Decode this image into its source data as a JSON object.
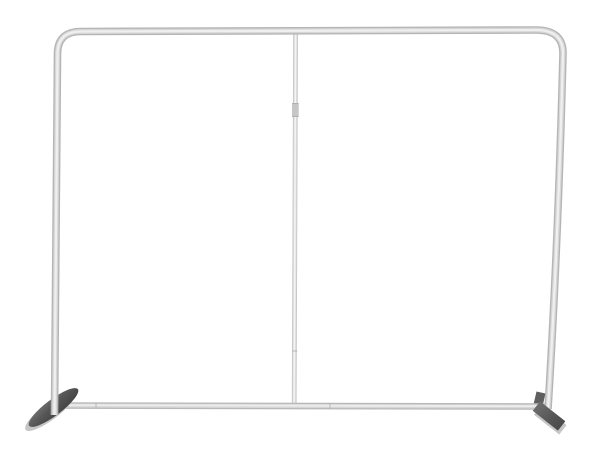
{
  "scene": {
    "type": "product-photo",
    "description": "Empty silver aluminum tube frame for a tension-fabric display backdrop, rounded top corners, vertical center support pole, two dark angled stabilizer feet, on a plain white background",
    "parts": {
      "top_bar": "top horizontal tube",
      "left_leg": "left vertical tube",
      "right_leg": "right vertical tube",
      "bottom_bar": "bottom horizontal tube",
      "center_pole": "thin center support pole with connector sleeve",
      "left_foot": "left angled stabilizer foot",
      "right_foot": "right angled stabilizer foot"
    }
  },
  "palette": {
    "background": "#ffffff",
    "tube_edge": "#b5b5b5",
    "tube_mid": "#d6d6d6",
    "tube_highlight": "#efefef",
    "bar_edge": "#b8b8b8",
    "bar_mid": "#d6d6d6",
    "bar_highlight": "#ececec",
    "pole_edge": "#c9c9c9",
    "pole_mid": "#e2e2e2",
    "pole_highlight": "#f4f4f4",
    "pole_joint": "#c6c6c6",
    "seam": "#a9a9a9",
    "bar_seam": "#aeaeae",
    "foot_light_edge": "#c6c6c6",
    "foot_dark_top": "#747474",
    "foot_dark_mid": "#575757",
    "foot_dark_deep": "#454545",
    "bracket_dark": "#5f5f5f"
  }
}
